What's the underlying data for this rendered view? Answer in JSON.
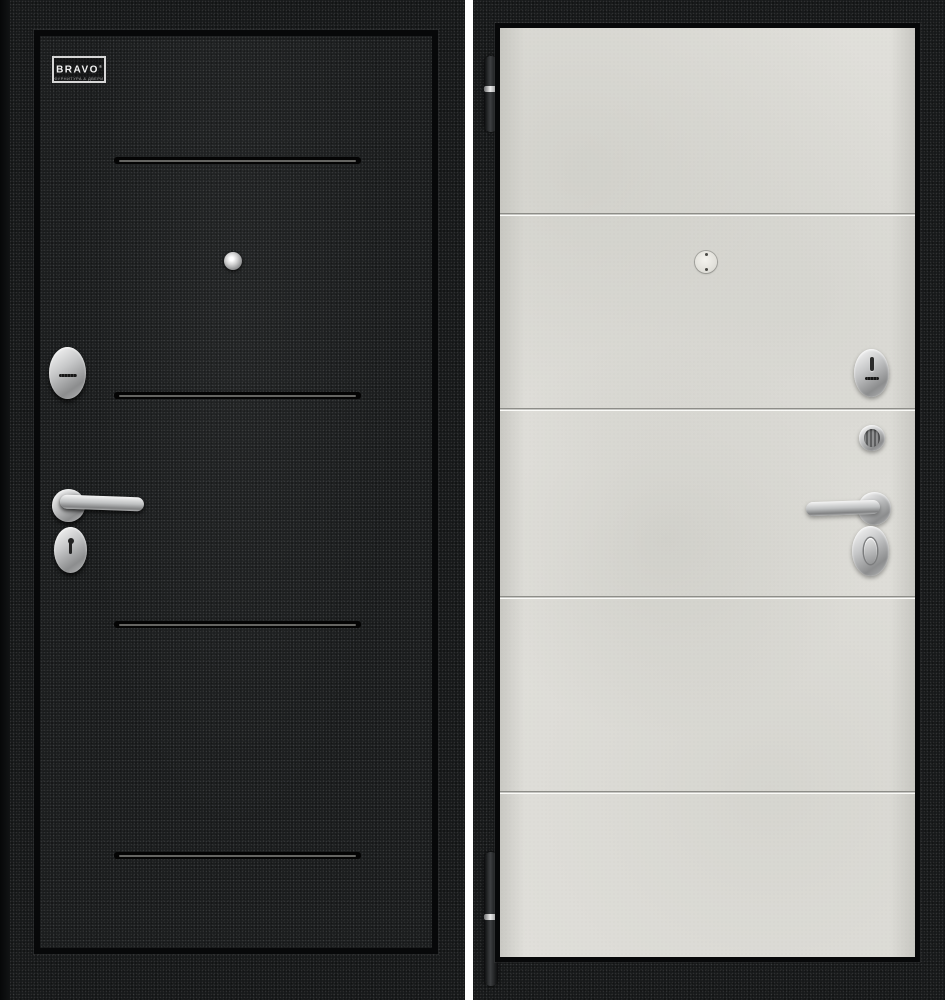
{
  "window": {
    "width": 945,
    "height": 1000,
    "background": "#ffffff"
  },
  "left_door": {
    "logo": {
      "brand": "BRAVO",
      "registered": "®",
      "tagline": "ФУРНИТУРА & ДВЕРИ"
    },
    "colors": {
      "surface": "#1b1d1e",
      "frame": "#17191a",
      "frame_edge": "#070809",
      "groove_dark": "#040404",
      "groove_highlight": "#6a6a67",
      "hardware_silver": "#c6c7c8"
    },
    "groove_count": 4,
    "hardware_icons": [
      "peephole-icon",
      "cylinder-escutcheon-icon",
      "lever-handle-icon",
      "keyhole-escutcheon-icon"
    ]
  },
  "right_door": {
    "colors": {
      "panel": "#e1e0db",
      "frame": "#17191a",
      "groove_line": "#8d8d88",
      "groove_highlight": "#ffffff",
      "hardware_silver": "#c6c7c8",
      "hinge": "#3d3f41"
    },
    "groove_count": 4,
    "hardware_icons": [
      "hinge-icon",
      "peephole-icon",
      "thumbturn-escutcheon-icon",
      "cylinder-knob-icon",
      "lever-handle-icon",
      "oval-thumbturn-escutcheon-icon"
    ]
  },
  "divider_color": "#ffffff"
}
